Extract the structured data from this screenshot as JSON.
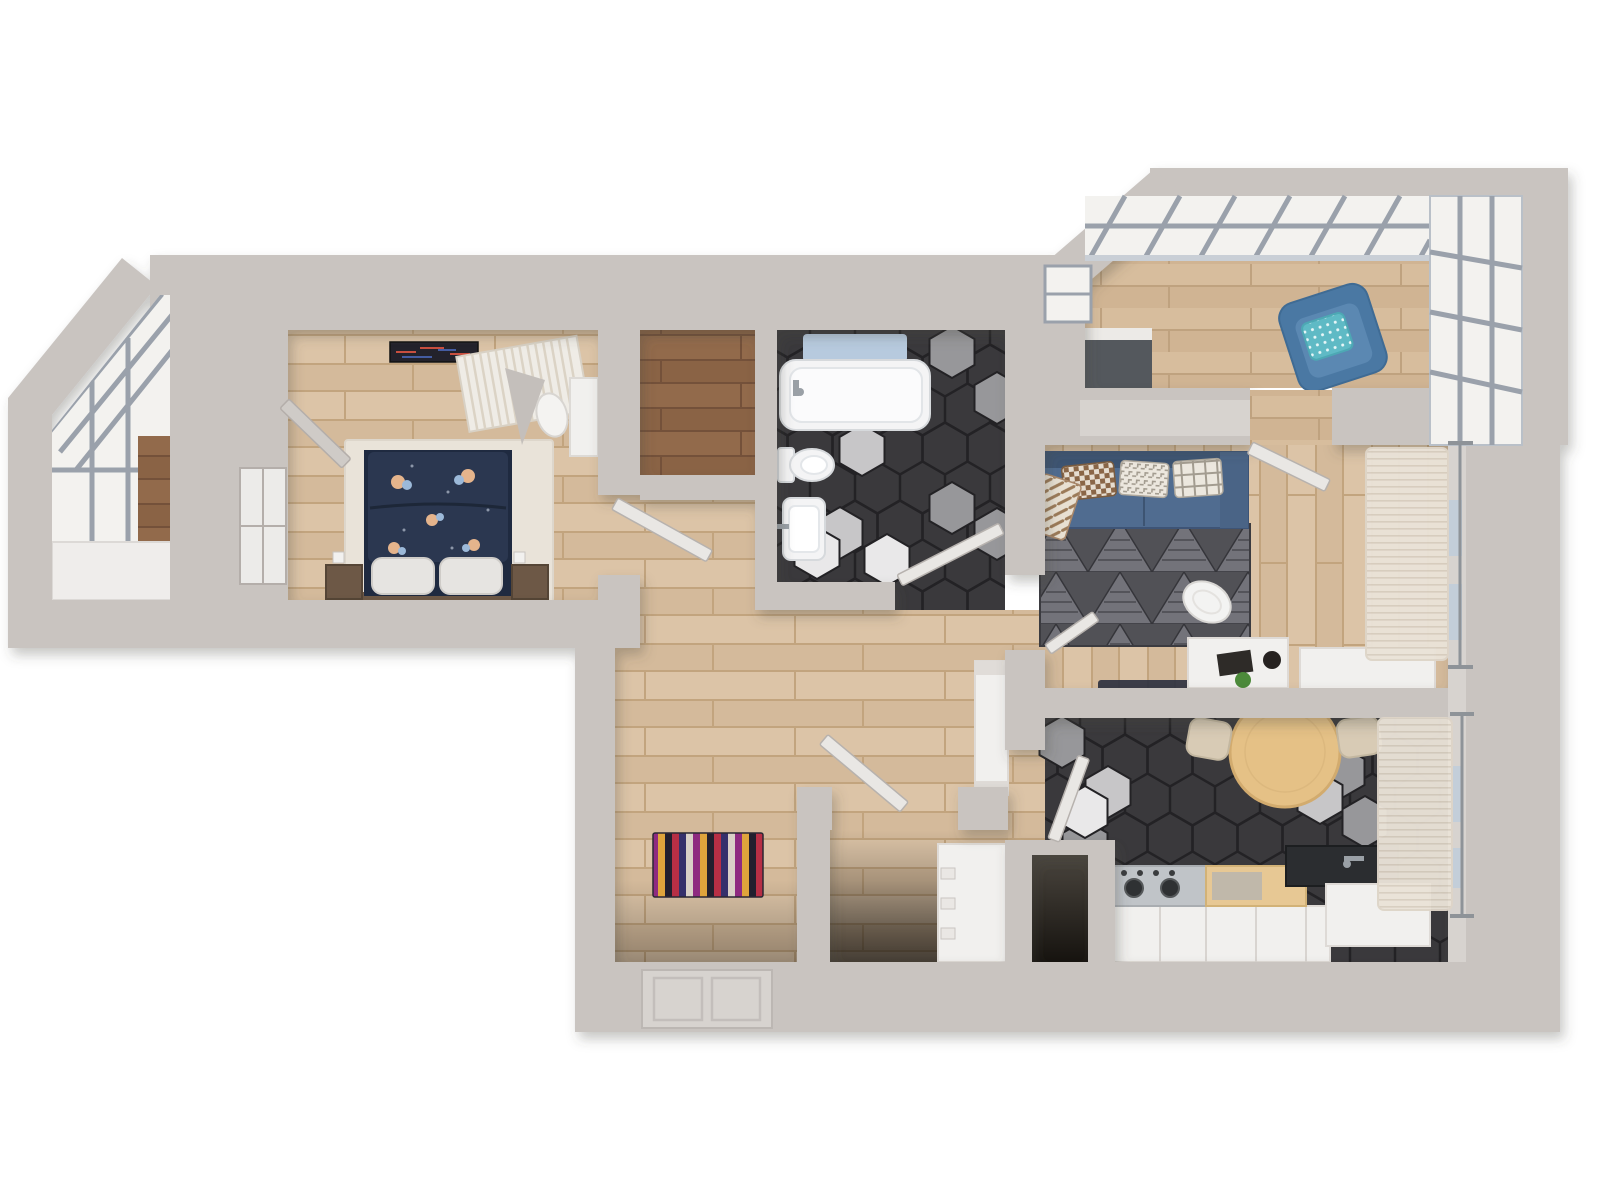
{
  "title": "apartment-3d-floor-plan-render",
  "palette": {
    "bg": "#ffffff",
    "wall": "#c9c4c0",
    "wallFace": "#d7d3cf",
    "floorWoodA": "#dcc4a7",
    "floorWoodB": "#d4ba9b",
    "floorWoodSeam": "#c2a47e",
    "floorDarkA": "#926a4b",
    "floorDarkB": "#8a6345",
    "floorDarkSeam": "#74513a",
    "balcWoodA": "#d7bd9d",
    "balcWoodB": "#d0b493",
    "balcWoodSeam": "#bfa27f",
    "hexBase": "#3a393c",
    "hexLine": "#232225",
    "hexGray": "#97979a",
    "hexGrayLight": "#c7c6c8",
    "hexWhite": "#e9e8e9",
    "porcelain": "#f4f4f5",
    "porcelainLine": "#d6d9dc",
    "matBlue": "#b7cade",
    "glass": "#f3f2ef",
    "glassBlue": "#c3ced9",
    "frame": "#9aa1ab",
    "frameLight": "#c9cfd6",
    "doorLeaf": "#e9e7e4",
    "doorLeafEdge": "#b7b2ae",
    "rugCream": "#e9e3d9",
    "bedNavy": "#2b3750",
    "bedNavyDark": "#1f2a40",
    "flowerPeach": "#e5b48c",
    "flowerBlue": "#9cb9d9",
    "pillowWhite": "#e6e4e1",
    "woodBrown": "#6d5846",
    "sofa": "#506c90",
    "sofaDark": "#3d5472",
    "rugTriBase": "#515156",
    "rugTriLight": "#73737a",
    "rugTriLine": "#35353a",
    "curtain": "#eae3d8",
    "curtainLine": "#d8cec0",
    "chairBlue": "#4a78a3",
    "chairBlueLight": "#5b88b2",
    "teal": "#5fbac5",
    "tableWood": "#e5c186",
    "tableWoodEdge": "#d2ab6e",
    "chairBeige": "#d8cbb5",
    "steel": "#c0c4c8",
    "steelDark": "#2f3133",
    "counterDark": "#2b2d30",
    "cabinet": "#f1f0ee",
    "cabinetLine": "#dedad6",
    "nicheTop": "#4a453e",
    "nicheBottom": "#16130f",
    "shadowColor": "#4a443f",
    "stripe1": "#b72f45",
    "stripe2": "#35306b",
    "stripe3": "#d9d0c7",
    "stripe4": "#8e2a80",
    "stripe5": "#dfa43c",
    "stripe6": "#221f2e",
    "checkBrown": "#8a6647",
    "checkCream": "#e6ddd0",
    "houndCream": "#ece7de",
    "houndGray": "#a39c90",
    "throwCream": "#e8e0d2",
    "throwBrown": "#9b7a58",
    "artDark": "#23222b",
    "trayDark": "#2e3140",
    "plant": "#4c8a3a"
  },
  "scene": {
    "view": "top-down-3d-render",
    "rooms": [
      {
        "id": "left-balcony",
        "floor": "glazing-and-sill",
        "features": [
          "slanted-glass-roof",
          "corner-diagonal-wall",
          "window-frames",
          "white-sill",
          "wood-strip"
        ]
      },
      {
        "id": "bedroom",
        "floor": "wood-light",
        "features": [
          "navy-floral-double-bed",
          "two-white-pillows",
          "two-nightstands",
          "cream-rug",
          "louvered-wardrobe",
          "wall-art",
          "desk",
          "stool",
          "open-window-sash",
          "wall-switches"
        ]
      },
      {
        "id": "closet",
        "floor": "wood-dark",
        "features": []
      },
      {
        "id": "bathroom",
        "floor": "hex-tile-dark",
        "features": [
          "bathtub",
          "blue-bath-mat",
          "toilet",
          "sink",
          "open-door"
        ]
      },
      {
        "id": "hallway",
        "floor": "wood-light",
        "features": [
          "striped-multicolor-rug",
          "entrance-door",
          "white-cabinet",
          "bedroom-door-leaf",
          "storage-door-leaf"
        ]
      },
      {
        "id": "storage-room",
        "floor": "wood-light",
        "features": [
          "white-dresser"
        ]
      },
      {
        "id": "duct-niche",
        "floor": "dark-shaft",
        "features": []
      },
      {
        "id": "living-room",
        "floor": "wood-light-vertical",
        "features": [
          "blue-sofa",
          "checkered-pillow",
          "houndstooth-pillow",
          "plaid-pillow",
          "throw-blanket",
          "triangle-pattern-rug",
          "white-desk",
          "desk-chair",
          "laptop",
          "plant",
          "dark-tray",
          "sheer-curtains",
          "curtain-rod",
          "balcony-door-leaf",
          "sideboard"
        ]
      },
      {
        "id": "kitchen",
        "floor": "hex-tile-dark",
        "features": [
          "round-wood-table",
          "two-beige-chairs",
          "gas-stove",
          "wood-counter",
          "dark-sink-counter",
          "white-cabinets",
          "sheer-curtain",
          "curtain-rod",
          "door-leaf"
        ]
      },
      {
        "id": "top-right-balcony",
        "floor": "wood-balcony",
        "features": [
          "slanted-glass-roof",
          "corner-window",
          "blue-armchair",
          "teal-dot-pillow",
          "dark-console"
        ]
      }
    ]
  }
}
